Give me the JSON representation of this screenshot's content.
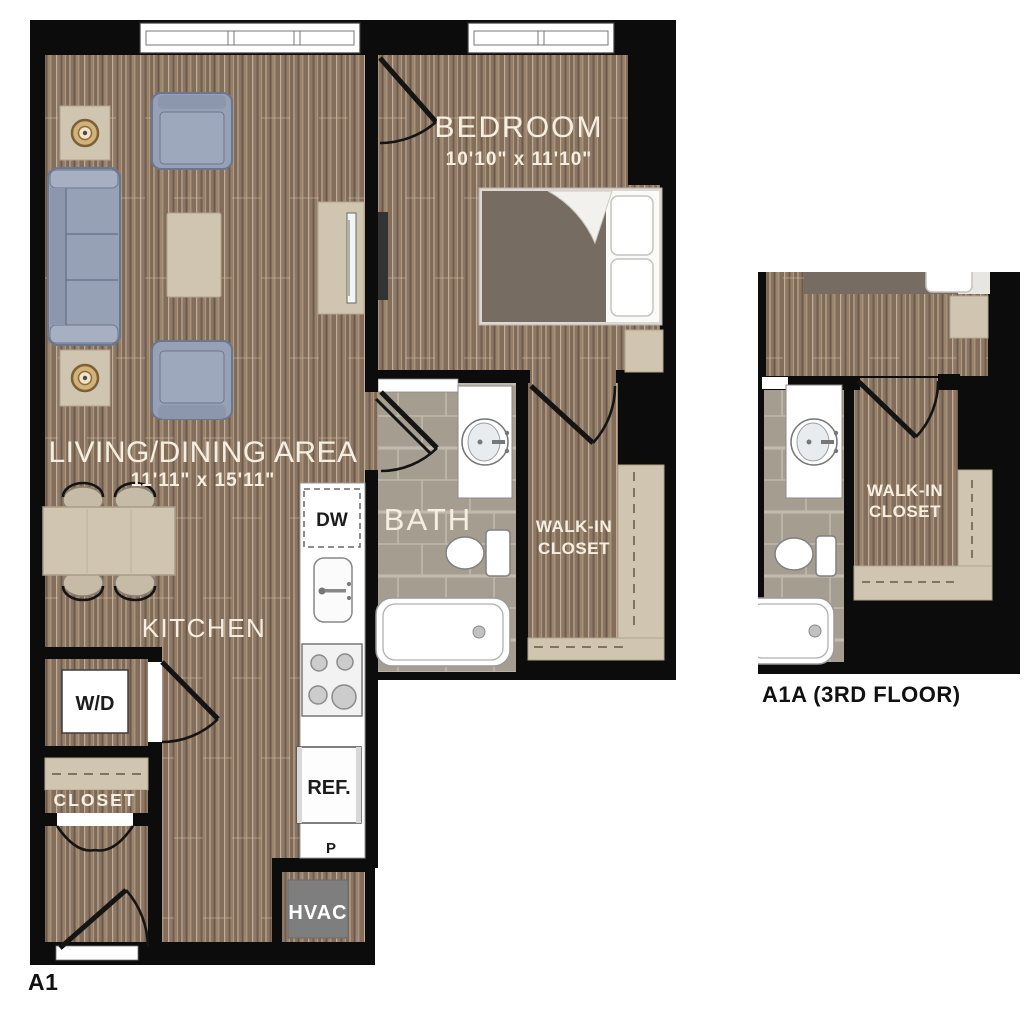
{
  "main_plan": {
    "plan_label": "A1",
    "rooms": {
      "bedroom": {
        "name": "BEDROOM",
        "dims": "10'10\" x 11'10\""
      },
      "living_dining": {
        "name": "LIVING/DINING AREA",
        "dims": "11'11\" x 15'11\""
      },
      "kitchen": {
        "name": "KITCHEN"
      },
      "bath": {
        "name": "BATH"
      },
      "walk_in_closet": {
        "line1": "WALK-IN",
        "line2": "CLOSET"
      },
      "entry_closet": {
        "name": "CLOSET"
      }
    },
    "labels": {
      "washer_dryer": "W/D",
      "dishwasher": "DW",
      "refrigerator": "REF.",
      "pantry": "P",
      "hvac": "HVAC"
    }
  },
  "inset_plan": {
    "plan_label": "A1A (3RD FLOOR)",
    "walk_in_closet": {
      "line1": "WALK-IN",
      "line2": "CLOSET"
    }
  },
  "colors": {
    "wall": "#0c0c0c",
    "wood_base": "#8d7867",
    "tile_base": "#a59d90",
    "upholstery_blue": "#97a1b6",
    "casegoods_tan": "#cfc5b0",
    "bed_linen_dark": "#776c61",
    "hvac_gray": "#7e7e7e",
    "label_light": "#f6efe1",
    "label_dark": "#1c1c1c"
  }
}
